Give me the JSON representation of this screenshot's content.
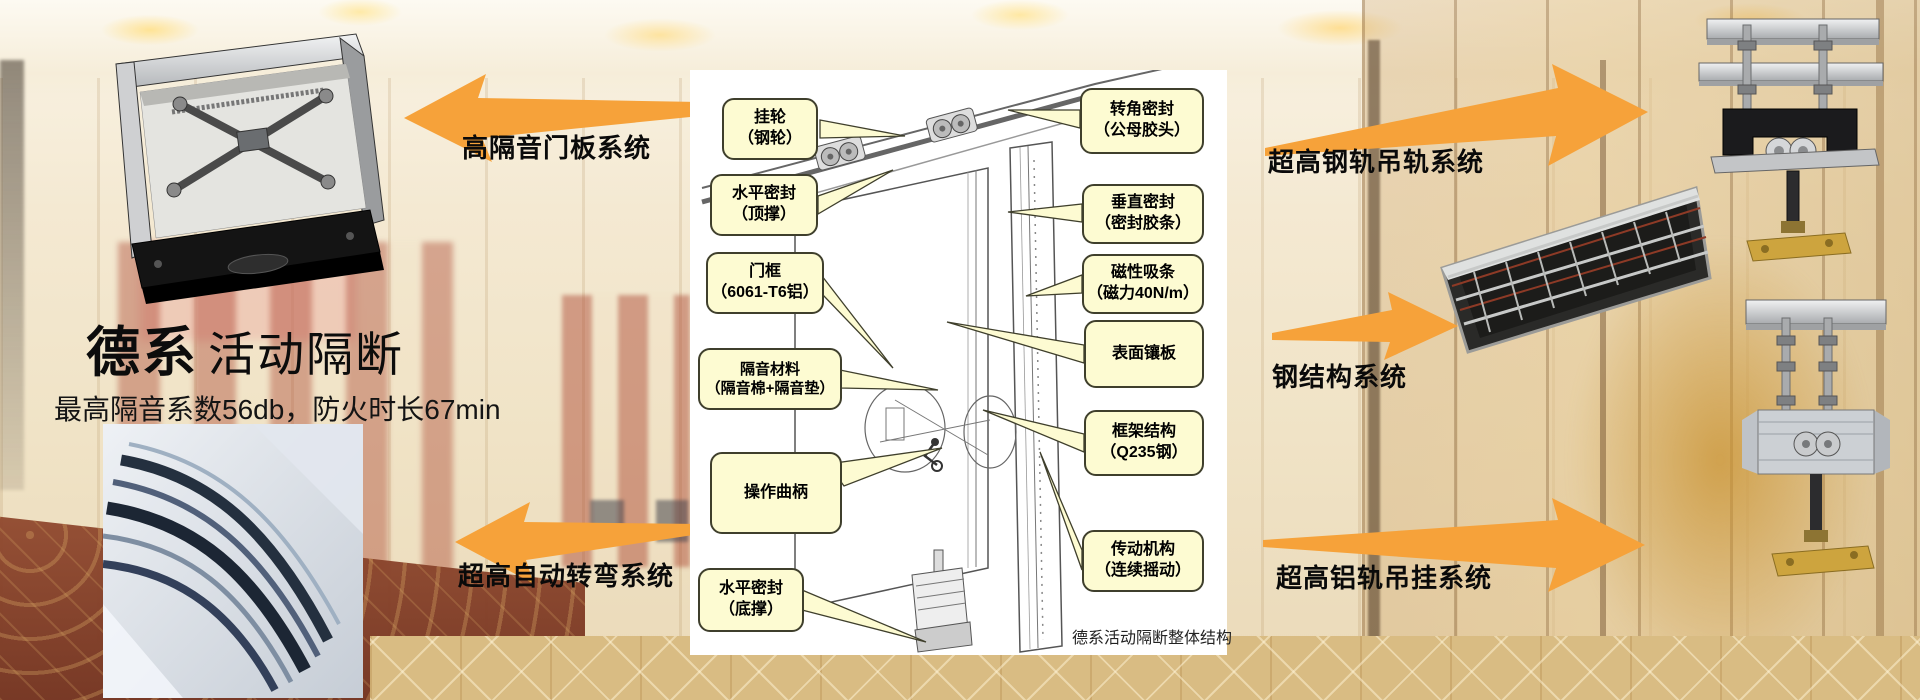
{
  "colors": {
    "accent_orange": "#F6A23A",
    "callout_fill": "#FDFBD2",
    "callout_border": "#3F3F2C",
    "panel_bg": "#FFFFFF",
    "wall_cream": "#F2E6CB",
    "carpet_red": "#8E4A31",
    "carpet_tan": "#D9BC83",
    "text_black": "#0A0A0A"
  },
  "header": {
    "brand_bold": "德系",
    "brand_rest": "活动隔断",
    "subtitle": "最高隔音系数56db，防火时长67min"
  },
  "arrows": {
    "left_top": {
      "label": "高隔音门板系统",
      "direction": "left"
    },
    "left_bottom": {
      "label": "超高自动转弯系统",
      "direction": "left"
    },
    "right_top": {
      "label": "超高钢轨吊轨系统",
      "direction": "right"
    },
    "right_middle": {
      "label": "钢结构系统",
      "direction": "right"
    },
    "right_bottom": {
      "label": "超高铝轨吊挂系统",
      "direction": "right"
    }
  },
  "diagram": {
    "caption": "德系活动隔断整体结构",
    "callouts_left": [
      {
        "line1": "挂轮",
        "line2": "（钢轮）"
      },
      {
        "line1": "水平密封",
        "line2": "（顶撑）"
      },
      {
        "line1": "门框",
        "line2": "（6061-T6铝）"
      },
      {
        "line1": "隔音材料",
        "line2": "（隔音棉+隔音垫）"
      },
      {
        "line1": "操作曲柄",
        "line2": ""
      },
      {
        "line1": "水平密封",
        "line2": "（底撑）"
      }
    ],
    "callouts_right": [
      {
        "line1": "转角密封",
        "line2": "（公母胶头）"
      },
      {
        "line1": "垂直密封",
        "line2": "（密封胶条）"
      },
      {
        "line1": "磁性吸条",
        "line2": "（磁力40N/m）"
      },
      {
        "line1": "表面镶板",
        "line2": ""
      },
      {
        "line1": "框架结构",
        "line2": "（Q235钢）"
      },
      {
        "line1": "传动机构",
        "line2": "（连续摇动）"
      }
    ]
  },
  "images": {
    "top_left": "door-panel-top-seal-mechanism-photo",
    "bottom_left": "curved-track-closeup-photo",
    "middle_right": "steel-frame-structure-photo",
    "top_right": "steel-track-hanger-hardware-photo",
    "bottom_right": "aluminum-track-hanger-hardware-photo"
  }
}
